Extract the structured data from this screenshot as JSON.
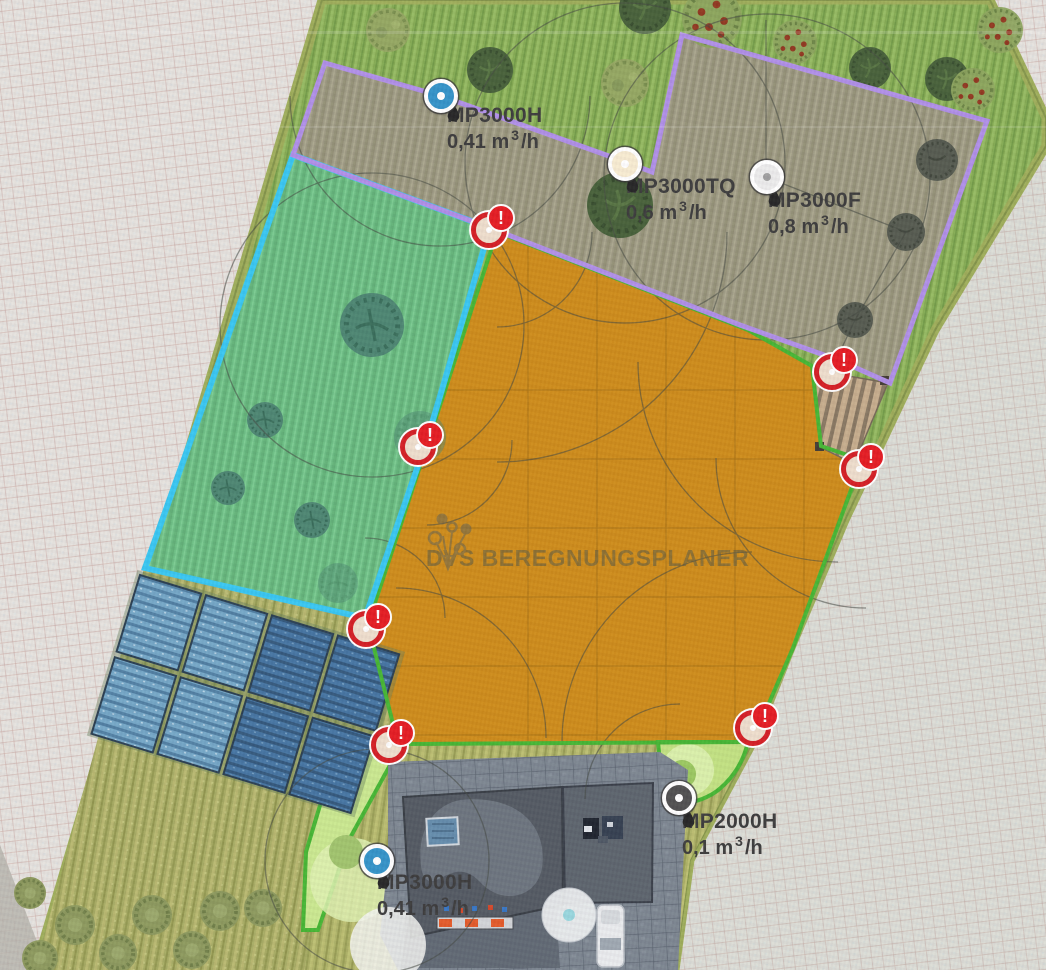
{
  "watermark": {
    "text": "DVS BEREGNUNGSPLANER"
  },
  "warning_badge": "!",
  "legend_colors": {
    "selected_zone_fill": "#cb860f",
    "zone_border_purple": "#ac8ae6",
    "zone_border_cyan": "#2fc4f1",
    "zone_border_green": "#3db32a",
    "warning_red": "#d2141a"
  },
  "sprinklers": [
    {
      "model": "MP3000H",
      "flow": "0,41 m³/h",
      "marker_color": "#2a8ec5",
      "dot_color": "#ffffff",
      "x": 441,
      "y": 96,
      "label_x": 447,
      "label_y": 104
    },
    {
      "model": "MP3000TQ",
      "flow": "0,6 m³/h",
      "marker_color": "#f7ebcf",
      "dot_color": "#ffffff",
      "x": 625,
      "y": 164,
      "label_x": 626,
      "label_y": 175
    },
    {
      "model": "MP3000F",
      "flow": "0,8 m³/h",
      "marker_color": "#ebebeb",
      "dot_color": "#9b9b9b",
      "x": 767,
      "y": 177,
      "label_x": 768,
      "label_y": 189
    },
    {
      "model": "MP2000H",
      "flow": "0,1 m³/h",
      "marker_color": "#484848",
      "dot_color": "#ffffff",
      "x": 679,
      "y": 798,
      "label_x": 682,
      "label_y": 810
    },
    {
      "model": "MP3000H",
      "flow": "0,41 m³/h",
      "marker_color": "#2a8ec5",
      "dot_color": "#ffffff",
      "x": 377,
      "y": 861,
      "label_x": 377,
      "label_y": 871
    }
  ],
  "warnings": [
    {
      "x": 489,
      "y": 230
    },
    {
      "x": 832,
      "y": 372
    },
    {
      "x": 859,
      "y": 469
    },
    {
      "x": 418,
      "y": 447
    },
    {
      "x": 366,
      "y": 629
    },
    {
      "x": 389,
      "y": 745
    },
    {
      "x": 753,
      "y": 728
    }
  ]
}
